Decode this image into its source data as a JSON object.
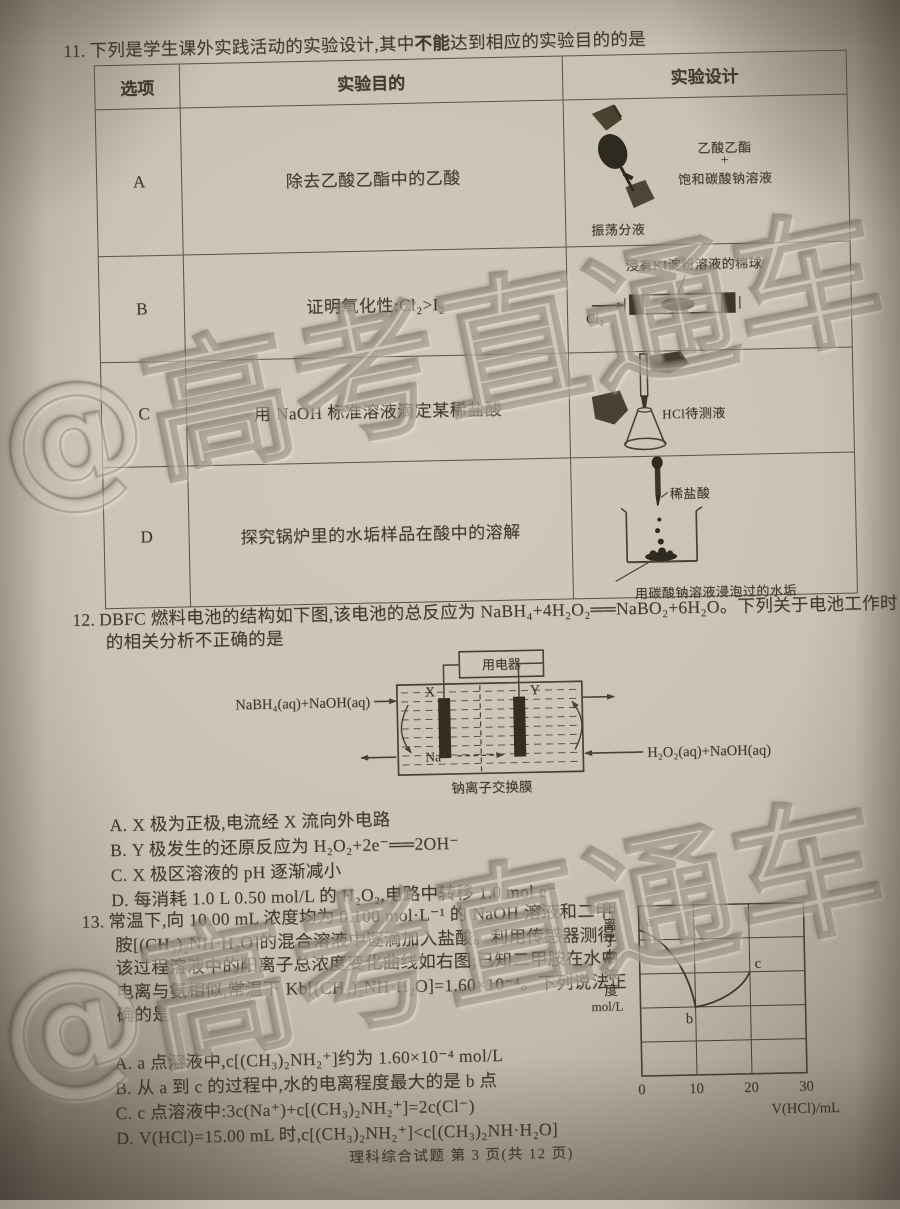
{
  "page": {
    "footer": "理科综合试题 第 3 页(共 12 页)",
    "watermark": "@高考直通车",
    "paper_color": "#cac2b3",
    "ink_color": "#413a2f"
  },
  "q11": {
    "number": "11.",
    "stem_pre": "下列是学生课外实践活动的实验设计,其中",
    "stem_emphasis": "不能",
    "stem_post": "达到相应的实验目的的是",
    "table": {
      "headers": [
        "选项",
        "实验目的",
        "实验设计"
      ],
      "rows": [
        {
          "option": "A",
          "purpose": "除去乙酸乙酯中的乙酸",
          "labels": {
            "top": "乙酸乙酯",
            "plus": "+",
            "bottom": "饱和碳酸钠溶液",
            "caption": "振荡分液"
          }
        },
        {
          "option": "B",
          "purpose": "证明氧化性:Cl₂>I₂",
          "labels": {
            "top": "浸有KI淀粉溶液的棉球",
            "gas": "Cl₂"
          }
        },
        {
          "option": "C",
          "purpose": "用 NaOH 标准溶液滴定某稀盐酸",
          "labels": {
            "flask": "HCl待测液"
          }
        },
        {
          "option": "D",
          "purpose": "探究锅炉里的水垢样品在酸中的溶解",
          "labels": {
            "dropper": "稀盐酸",
            "caption": "用碳酸钠溶液浸泡过的水垢"
          }
        }
      ]
    }
  },
  "q12": {
    "number": "12.",
    "stem": "DBFC 燃料电池的结构如下图,该电池的总反应为 NaBH₄+4H₂O₂══NaBO₂+6H₂O。下列关于电池工作时的相关分析不正确的是",
    "diagram": {
      "device": "用电器",
      "electrode_x": "X",
      "electrode_y": "Y",
      "ion": "Na⁺",
      "left_feed": "NaBH₄(aq)+NaOH(aq)",
      "right_feed": "H₂O₂(aq)+NaOH(aq)",
      "membrane": "钠离子交换膜"
    },
    "options": [
      {
        "letter": "A.",
        "text": "X 极为正极,电流经 X 流向外电路"
      },
      {
        "letter": "B.",
        "text": "Y 极发生的还原反应为 H₂O₂+2e⁻══2OH⁻"
      },
      {
        "letter": "C.",
        "text": "X 极区溶液的 pH 逐渐减小"
      },
      {
        "letter": "D.",
        "text": "每消耗 1.0 L 0.50 mol/L 的 H₂O₂,电路中转移 1.0 mol e⁻"
      }
    ]
  },
  "q13": {
    "number": "13.",
    "stem": "常温下,向 10.00 mL 浓度均为 0.100 mol·L⁻¹ 的 NaOH 溶液和二甲胺[(CH₃)₂NH·H₂O]的混合溶液中逐滴加入盐酸。利用传感器测得该过程溶液中的阳离子总浓度变化曲线如右图;已知二甲胺在水中电离与氨相似,常温下 Kb[(CH₃)₂NH·H₂O]=1.60×10⁻⁴。下列说法正确的是",
    "options": [
      {
        "letter": "A.",
        "text": "a 点溶液中,c[(CH₃)₂NH₂⁺]约为 1.60×10⁻⁴ mol/L"
      },
      {
        "letter": "B.",
        "text": "从 a 到 c 的过程中,水的电离程度最大的是 b 点"
      },
      {
        "letter": "C.",
        "text": "c 点溶液中:3c(Na⁺)+c[(CH₃)₂NH₂⁺]=2c(Cl⁻)"
      },
      {
        "letter": "D.",
        "text": "V(HCl)=15.00 mL 时,c[(CH₃)₂NH₂⁺]<c[(CH₃)₂NH·H₂O]"
      }
    ],
    "graph": {
      "ylabel": "阳离子总浓度",
      "yunit": "mol/L",
      "xlabel": "V(HCl)/mL",
      "xticks": [
        "0",
        "10",
        "20",
        "30"
      ],
      "point_a": "a",
      "point_b": "b",
      "point_c": "c"
    }
  },
  "chart_data": {
    "type": "line",
    "title": "",
    "xlabel": "V(HCl)/mL",
    "ylabel": "阳离子总浓度 mol/L",
    "xlim": [
      0,
      30
    ],
    "x_ticks": [
      0,
      10,
      20,
      30
    ],
    "y_axis_labeled": false,
    "grid": true,
    "series": [
      {
        "name": "阳离子总浓度",
        "points": [
          {
            "label": "a",
            "x": 0,
            "y_fraction_of_axis": 0.86
          },
          {
            "label": "b",
            "x": 10,
            "y_fraction_of_axis": 0.4
          },
          {
            "label": "c",
            "x": 20,
            "y_fraction_of_axis": 0.6
          }
        ],
        "shape": "concave decrease from a to minimum b, then rise to c"
      }
    ],
    "legend": false
  }
}
